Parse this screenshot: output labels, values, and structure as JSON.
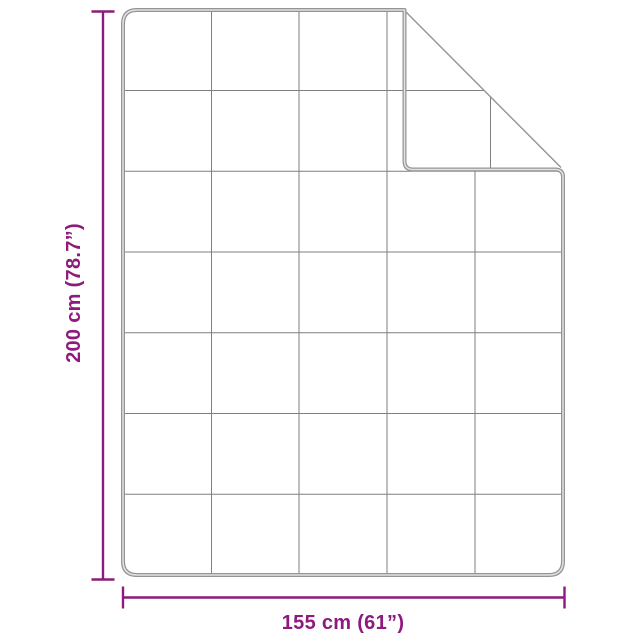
{
  "diagram": {
    "type": "product-dimension-diagram",
    "subject": "blanket-with-folded-corner",
    "height_label": "200 cm (78.7”)",
    "width_label": "155 cm (61”)",
    "grid_columns": 5,
    "grid_rows": 7,
    "colors": {
      "dimension": "#8E1A7D",
      "outline": "#949494",
      "outline_highlight": "#E2E2E2",
      "grid": "#7F7F7F",
      "background": "#FFFFFF"
    }
  }
}
